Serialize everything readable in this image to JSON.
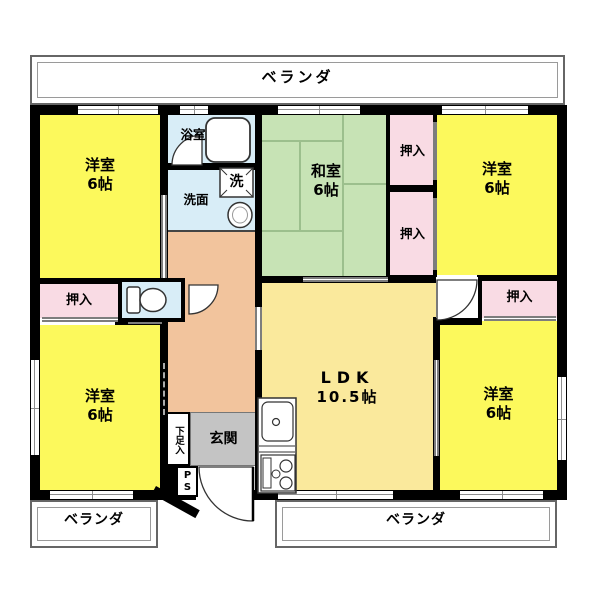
{
  "plan_labels": {
    "veranda": "ベランダ",
    "closet": "押入",
    "bath": "浴室",
    "washroom": "洗面",
    "washer": "洗",
    "entrance": "玄関",
    "shoe_cabinet": "下足入",
    "pipe_space": "PS"
  },
  "rooms": [
    {
      "name": "洋室",
      "size": "6帖",
      "position": "top-left"
    },
    {
      "name": "和室",
      "size": "6帖",
      "position": "top-center"
    },
    {
      "name": "洋室",
      "size": "6帖",
      "position": "top-right"
    },
    {
      "name": "洋室",
      "size": "6帖",
      "position": "bottom-left"
    },
    {
      "name": "LDK",
      "size": "10.5帖",
      "position": "center"
    },
    {
      "name": "洋室",
      "size": "6帖",
      "position": "bottom-right"
    }
  ],
  "colors": {
    "western_room_yellow": "#FCF95C",
    "ldk_pale_yellow": "#FAE99C",
    "tatami_green": "#C7E3B5",
    "tatami_line_green": "#9CBF8D",
    "closet_pink": "#F9DBE4",
    "wet_area_blue": "#D8EDF7",
    "hallway_tan": "#F2C49D",
    "entrance_gray": "#C4C4C4",
    "wall_black": "#000000",
    "window_line_gray": "#8F8F8F"
  }
}
